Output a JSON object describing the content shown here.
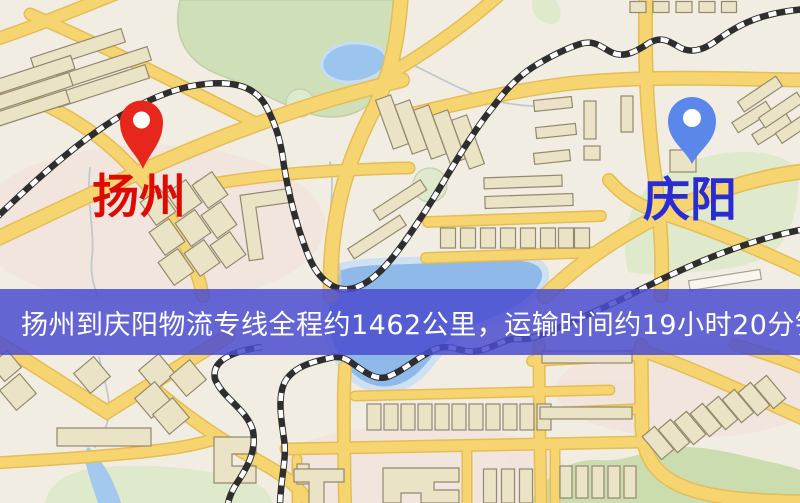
{
  "map": {
    "markers": [
      {
        "id": "origin",
        "label": "扬州",
        "label_color": "#dd0b04",
        "pin_color": "#e8271c"
      },
      {
        "id": "destination",
        "label": "庆阳",
        "label_color": "#2b2bd2",
        "pin_color": "#5b87ea"
      }
    ],
    "banner": {
      "text": "扬州到庆阳物流专线全程约1462公里，运输时间约19小时20分钟.",
      "bg": "#4b4cd0d9",
      "fg": "#ffffff"
    },
    "colors": {
      "background": "#f2ede3",
      "road": "#f6d571",
      "road_casing": "#e4bd55",
      "water": "#8fb9e8",
      "water_light": "#cde1f3",
      "green": "#cfdfb8",
      "green_light": "#dfe9cc",
      "building": "#ebe3c6",
      "building_stroke": "#93896f",
      "railway": "#2e2e2e",
      "contour": "#c0c9cf",
      "pink": "#f0dbd6"
    }
  }
}
